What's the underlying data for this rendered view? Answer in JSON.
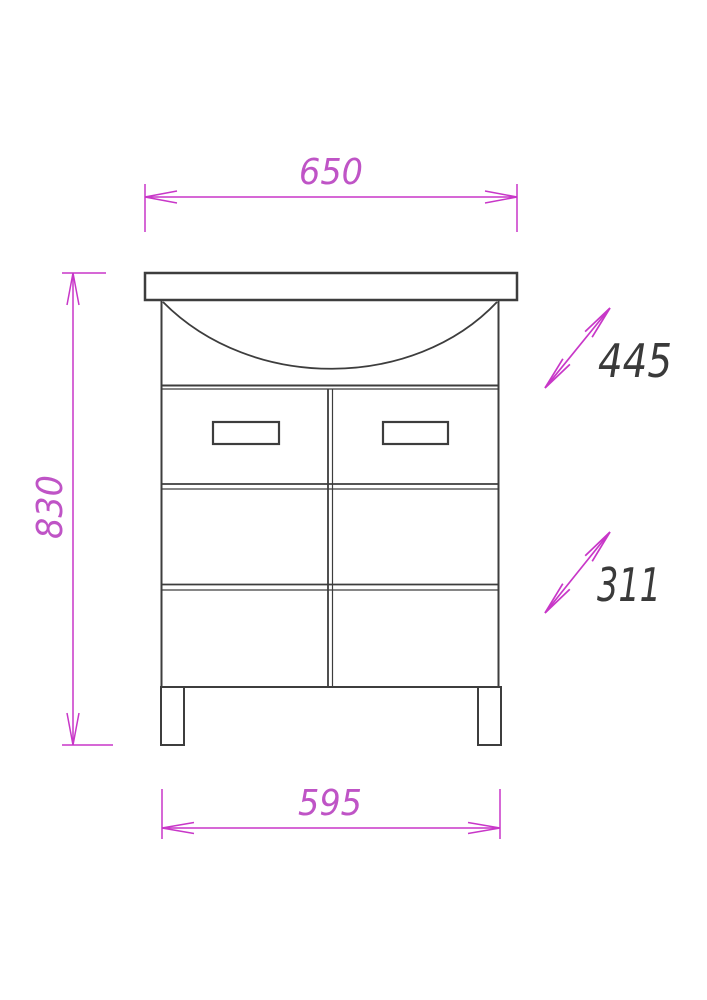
{
  "drawing": {
    "subject": "bathroom vanity cabinet with sink, front elevation technical drawing",
    "colors": {
      "background": "#ffffff",
      "outline": "#3d3d3d",
      "dimension_line": "#c837c8",
      "dimension_text": "#bf54c6",
      "section_label_text": "#3a3a3a"
    },
    "dimensions": {
      "top_width": "650",
      "overall_height": "830",
      "bottom_width": "595",
      "upper_section": "445",
      "lower_section": "311"
    }
  }
}
